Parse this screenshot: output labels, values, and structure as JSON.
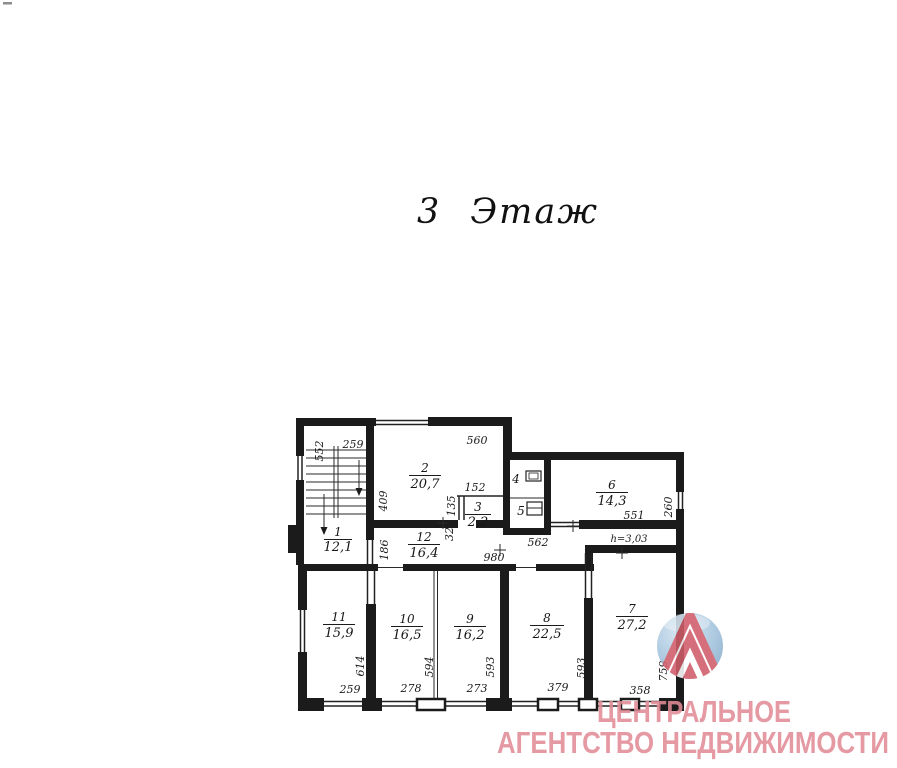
{
  "page": {
    "title": "3 Этаж"
  },
  "floorplan": {
    "rooms": [
      {
        "number": "1",
        "area": "12,1"
      },
      {
        "number": "2",
        "area": "20,7"
      },
      {
        "number": "3",
        "area": "2,2"
      },
      {
        "number": "4",
        "area": ""
      },
      {
        "number": "5",
        "area": ""
      },
      {
        "number": "6",
        "area": "14,3"
      },
      {
        "number": "7",
        "area": "27,2"
      },
      {
        "number": "8",
        "area": "22,5"
      },
      {
        "number": "9",
        "area": "16,2"
      },
      {
        "number": "10",
        "area": "16,5"
      },
      {
        "number": "11",
        "area": "15,9"
      },
      {
        "number": "12",
        "area": "16,4"
      }
    ],
    "height_note": "h=3,03",
    "dims": {
      "stair_left": "552",
      "stair_top": "259",
      "room2_top": "560",
      "room2_left": "409",
      "room3_top": "152",
      "room3_left_upper": "135",
      "room3_left_lower": "32",
      "corridor_left": "186",
      "below_wc": "562",
      "room6_bottom": "551",
      "room6_right": "260",
      "corridor_width": "980",
      "room11_side": "614",
      "room10_side": "594",
      "room9_side": "593",
      "room8_side": "593",
      "room7_side": "759",
      "bottom_room11": "259",
      "bottom_room10": "278",
      "bottom_room9": "273",
      "bottom_room8": "379",
      "bottom_room7": "358"
    }
  },
  "watermark": {
    "line1": "ЦЕНТРАЛЬНОЕ",
    "line2": "АГЕНТСТВО НЕДВИЖИМОСТИ",
    "text_color": "#e18b96",
    "logo_blue_light": "#cfe2f0",
    "logo_blue_dark": "#86abcb",
    "logo_red": "#d05c69"
  }
}
